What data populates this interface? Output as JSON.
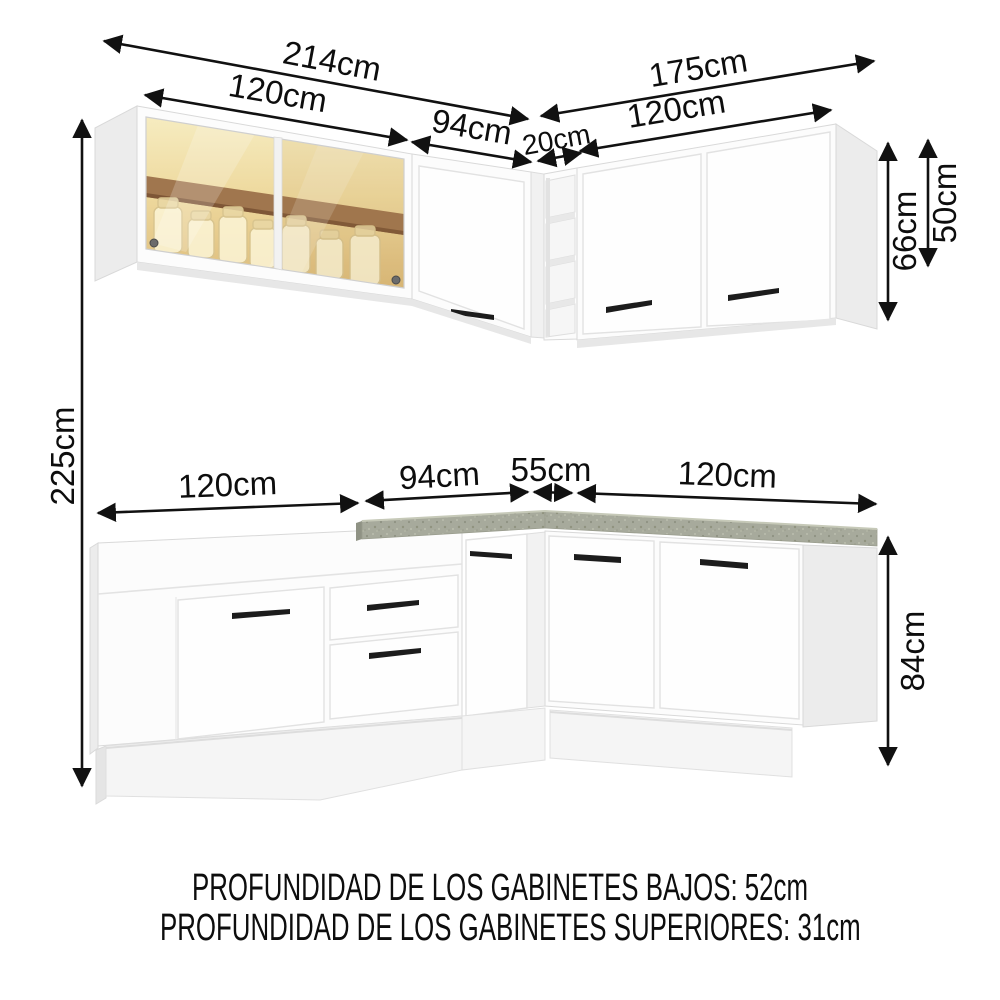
{
  "dimensions": {
    "upper": {
      "total_left": "214cm",
      "glass_cabinet": "120cm",
      "corner_left": "94cm",
      "open_shelf": "20cm",
      "total_right": "175cm",
      "right_cabinet": "120cm",
      "corner_height": "66cm",
      "glass_height": "50cm"
    },
    "overall_height": "225cm",
    "base": {
      "left_cabinet": "120cm",
      "corner_left": "94cm",
      "corner_right": "55cm",
      "right_cabinet": "120cm",
      "height": "84cm"
    }
  },
  "notes": {
    "base_depth": "PROFUNDIDAD DE LOS GABINETES BAJOS: 52cm",
    "upper_depth": "PROFUNDIDAD DE LOS GABINETES SUPERIORES: 31cm"
  },
  "colors": {
    "dimension_line": "#111111",
    "cabinet_white": "#fcfcfc",
    "countertop_gray": "#a7aa9c",
    "glass_amber": "#ecd79c",
    "handle_black": "#1c1c1c"
  }
}
